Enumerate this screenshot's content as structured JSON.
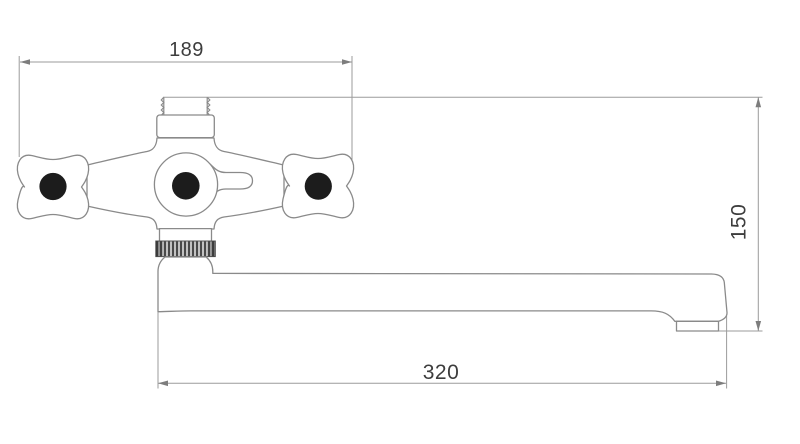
{
  "title": "Faucet dimension drawing",
  "drawing_type": "technical line drawing, front view of wall-mounted bath faucet with long swivel spout",
  "dimensions": {
    "top_width": {
      "value": "189",
      "orientation": "horizontal",
      "location": "top, between handle centers extension lines"
    },
    "right_height": {
      "value": "150",
      "orientation": "vertical",
      "location": "right side, from threaded tailpiece top to spout outlet bottom"
    },
    "bottom_length": {
      "value": "320",
      "orientation": "horizontal",
      "location": "bottom, spout length"
    }
  },
  "parts": {
    "left_handle": "cross-handle",
    "right_handle": "cross-handle",
    "center": "escutcheon with diverter lever",
    "top": "threaded tailpiece with bonnet",
    "middle": "knurled connection nut",
    "bottom": "long straight spout with end outlet"
  },
  "colors": {
    "background": "#ffffff",
    "object_outline": "#8a8a8a",
    "dimension_lines": "#9b9b9b",
    "label_text": "#3d3d3d",
    "handle_dots": "#1c1c1c",
    "knurl_dark": "#4a4a4a",
    "knurl_light": "#c2c2c2"
  }
}
